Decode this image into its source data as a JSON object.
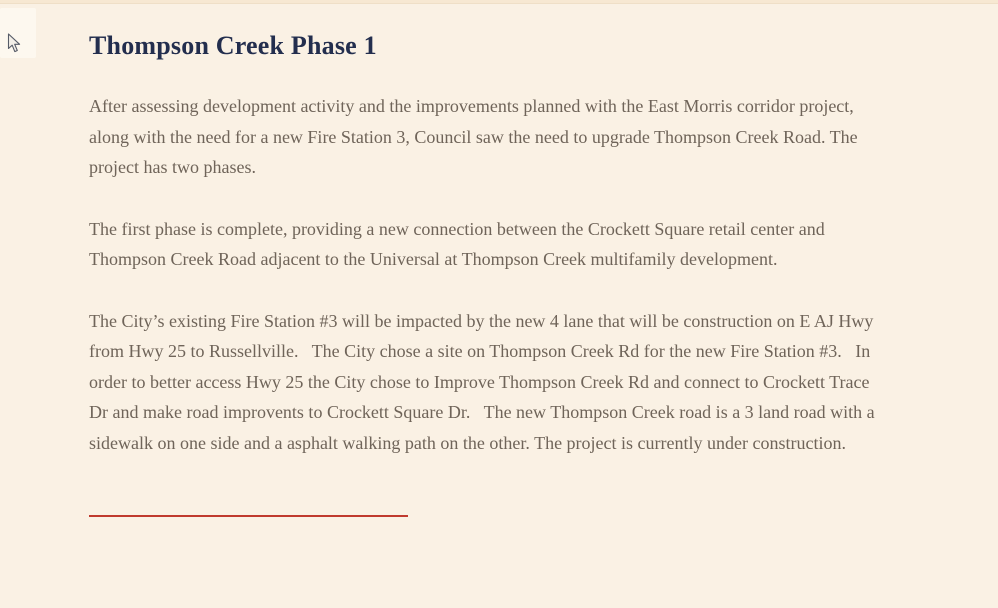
{
  "page": {
    "title": "Thompson Creek Phase 1",
    "paragraphs": [
      "After assessing development activity and the improvements planned with the East Morris corridor project, along with the need for a new Fire Station 3, Council saw the need to upgrade Thompson Creek Road. The project has two phases.",
      "The first phase is complete, providing a new connection between the Crockett Square retail center and Thompson Creek Road adjacent to the Universal at Thompson Creek multifamily development.",
      "The City’s existing Fire Station #3 will be impacted by the new 4 lane that will be construction on E AJ Hwy from Hwy 25 to Russellville.   The City chose a site on Thompson Creek Rd for the new Fire Station #3.   In order to better access Hwy 25 the City chose to Improve Thompson Creek Rd and connect to Crockett Trace Dr and make road improvents to Crockett Square Dr.   The new Thompson Creek road is a 3 land road with a sidewalk on one side and a asphalt walking path on the other. The project is currently under construction."
    ]
  },
  "icons": {
    "cursor": "arrow-pointer"
  },
  "colors": {
    "page_bg": "#faf1e4",
    "top_band": "#f7e8d2",
    "title_color": "#232e4e",
    "body_text": "#6f6459",
    "accent_red": "#c03a2e",
    "highlight_bg": "#fdf8ef",
    "cursor_fill": "#f3efe8",
    "cursor_outline": "#565b67"
  }
}
